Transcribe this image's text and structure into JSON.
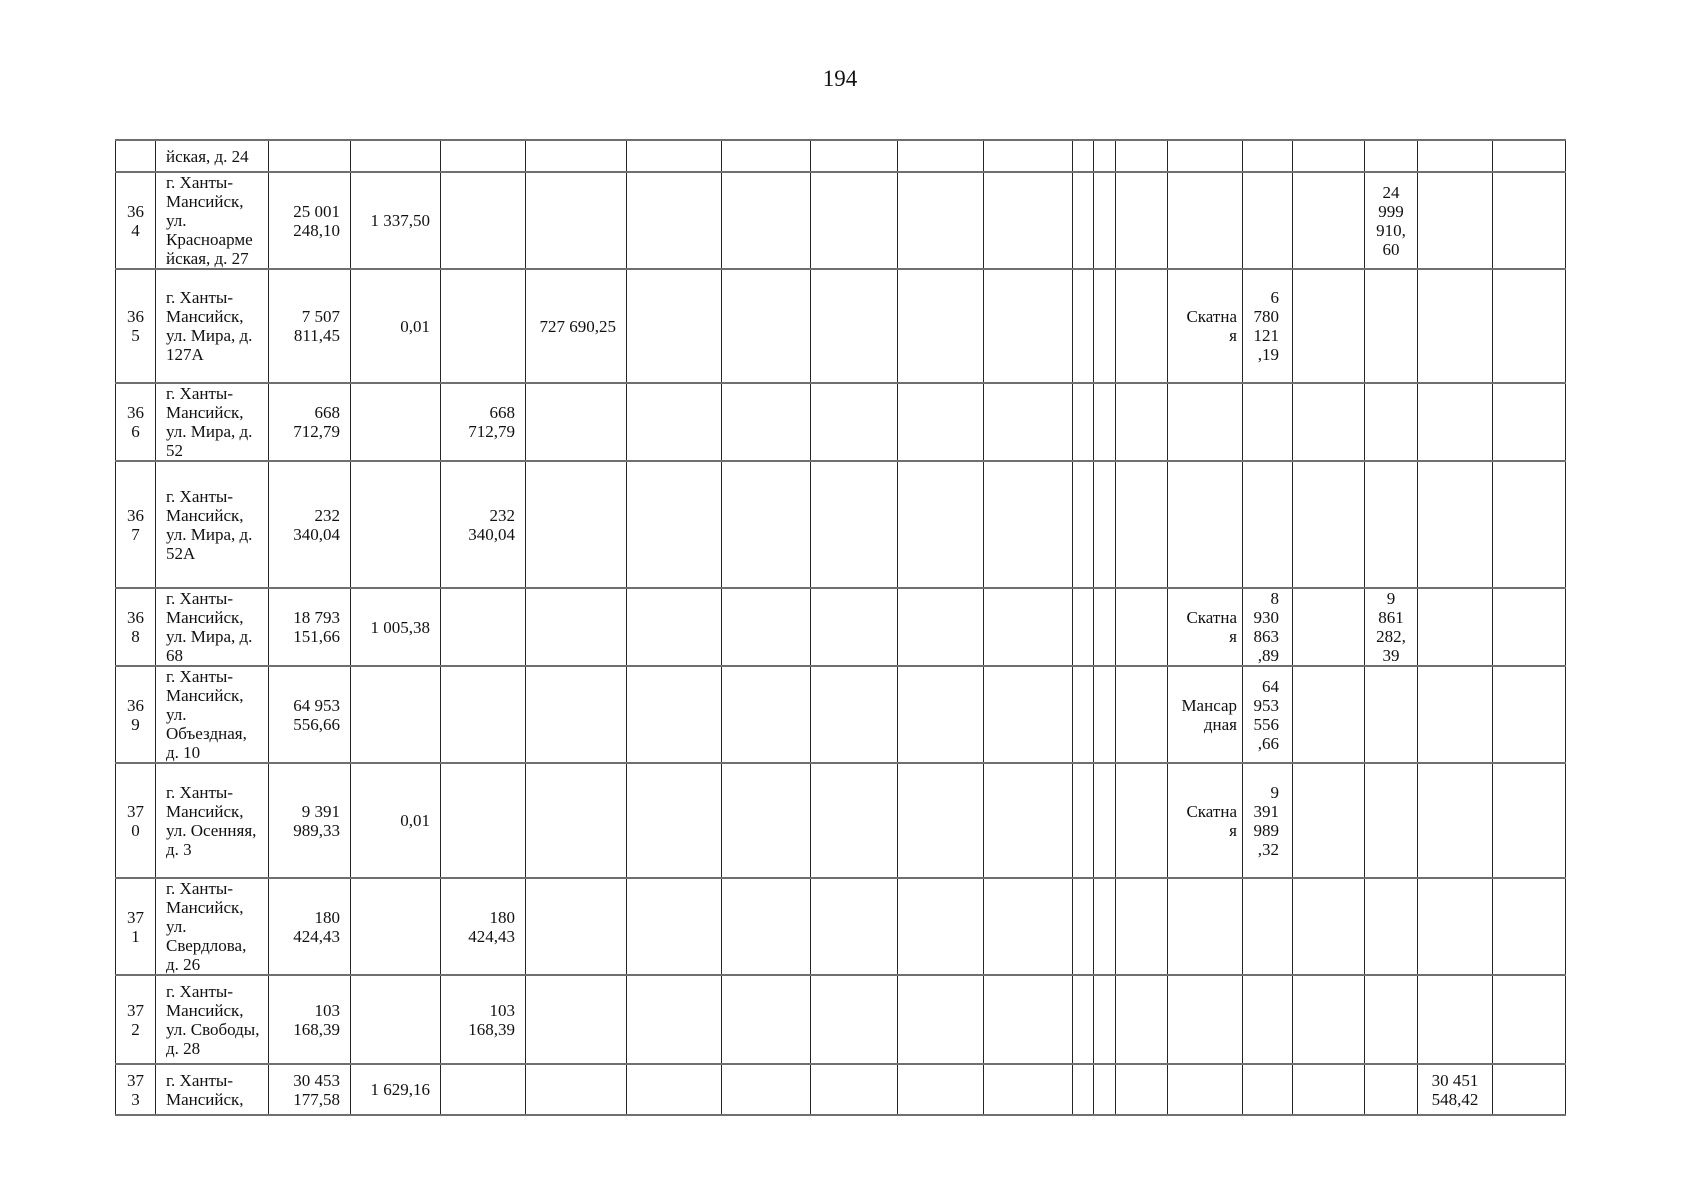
{
  "page_number": "194",
  "table": {
    "rows": [
      {
        "cells": [
          "",
          "йская, д. 24",
          "",
          "",
          "",
          "",
          "",
          "",
          "",
          "",
          "",
          "",
          "",
          "",
          "",
          "",
          "",
          "",
          "",
          ""
        ]
      },
      {
        "cells": [
          "36\n4",
          "г. Ханты-\nМансийск,\nул.\nКрасноарме\nйская, д. 27",
          "25 001\n248,10",
          "1 337,50",
          "",
          "",
          "",
          "",
          "",
          "",
          "",
          "",
          "",
          "",
          "",
          "",
          "",
          "24\n999\n910,\n60",
          "",
          ""
        ]
      },
      {
        "cells": [
          "36\n5",
          "г. Ханты-\nМансийск,\nул. Мира, д.\n127А",
          "7 507\n811,45",
          "0,01",
          "",
          "727 690,25",
          "",
          "",
          "",
          "",
          "",
          "",
          "",
          "",
          "Скатна\nя",
          "6\n780\n121\n,19",
          "",
          "",
          "",
          ""
        ]
      },
      {
        "cells": [
          "36\n6",
          "г. Ханты-\nМансийск,\nул. Мира, д.\n52",
          "668\n712,79",
          "",
          "668\n712,79",
          "",
          "",
          "",
          "",
          "",
          "",
          "",
          "",
          "",
          "",
          "",
          "",
          "",
          "",
          ""
        ]
      },
      {
        "cells": [
          "36\n7",
          "г. Ханты-\nМансийск,\nул. Мира, д.\n52А",
          "232\n340,04",
          "",
          "232\n340,04",
          "",
          "",
          "",
          "",
          "",
          "",
          "",
          "",
          "",
          "",
          "",
          "",
          "",
          "",
          ""
        ]
      },
      {
        "cells": [
          "36\n8",
          "г. Ханты-\nМансийск,\nул. Мира, д.\n68",
          "18 793\n151,66",
          "1 005,38",
          "",
          "",
          "",
          "",
          "",
          "",
          "",
          "",
          "",
          "",
          "Скатна\nя",
          "8\n930\n863\n,89",
          "",
          "9\n861\n282,\n39",
          "",
          ""
        ]
      },
      {
        "cells": [
          "36\n9",
          "г. Ханты-\nМансийск,\nул.\nОбъездная,\nд. 10",
          "64 953\n556,66",
          "",
          "",
          "",
          "",
          "",
          "",
          "",
          "",
          "",
          "",
          "",
          "Мансар\nдная",
          "64\n953\n556\n,66",
          "",
          "",
          "",
          ""
        ]
      },
      {
        "cells": [
          "37\n0",
          "г. Ханты-\nМансийск,\nул. Осенняя,\nд. 3",
          "9 391\n989,33",
          "0,01",
          "",
          "",
          "",
          "",
          "",
          "",
          "",
          "",
          "",
          "",
          "Скатна\nя",
          "9\n391\n989\n,32",
          "",
          "",
          "",
          ""
        ]
      },
      {
        "cells": [
          "37\n1",
          "г. Ханты-\nМансийск,\nул.\nСвердлова,\nд. 26",
          "180\n424,43",
          "",
          "180\n424,43",
          "",
          "",
          "",
          "",
          "",
          "",
          "",
          "",
          "",
          "",
          "",
          "",
          "",
          "",
          ""
        ]
      },
      {
        "cells": [
          "37\n2",
          "г. Ханты-\nМансийск,\nул. Свободы,\nд. 28",
          "103\n168,39",
          "",
          "103\n168,39",
          "",
          "",
          "",
          "",
          "",
          "",
          "",
          "",
          "",
          "",
          "",
          "",
          "",
          "",
          ""
        ]
      },
      {
        "cells": [
          "37\n3",
          "г. Ханты-\nМансийск,",
          "30 453\n177,58",
          "1 629,16",
          "",
          "",
          "",
          "",
          "",
          "",
          "",
          "",
          "",
          "",
          "",
          "",
          "",
          "",
          "30 451\n548,42",
          ""
        ]
      }
    ]
  }
}
